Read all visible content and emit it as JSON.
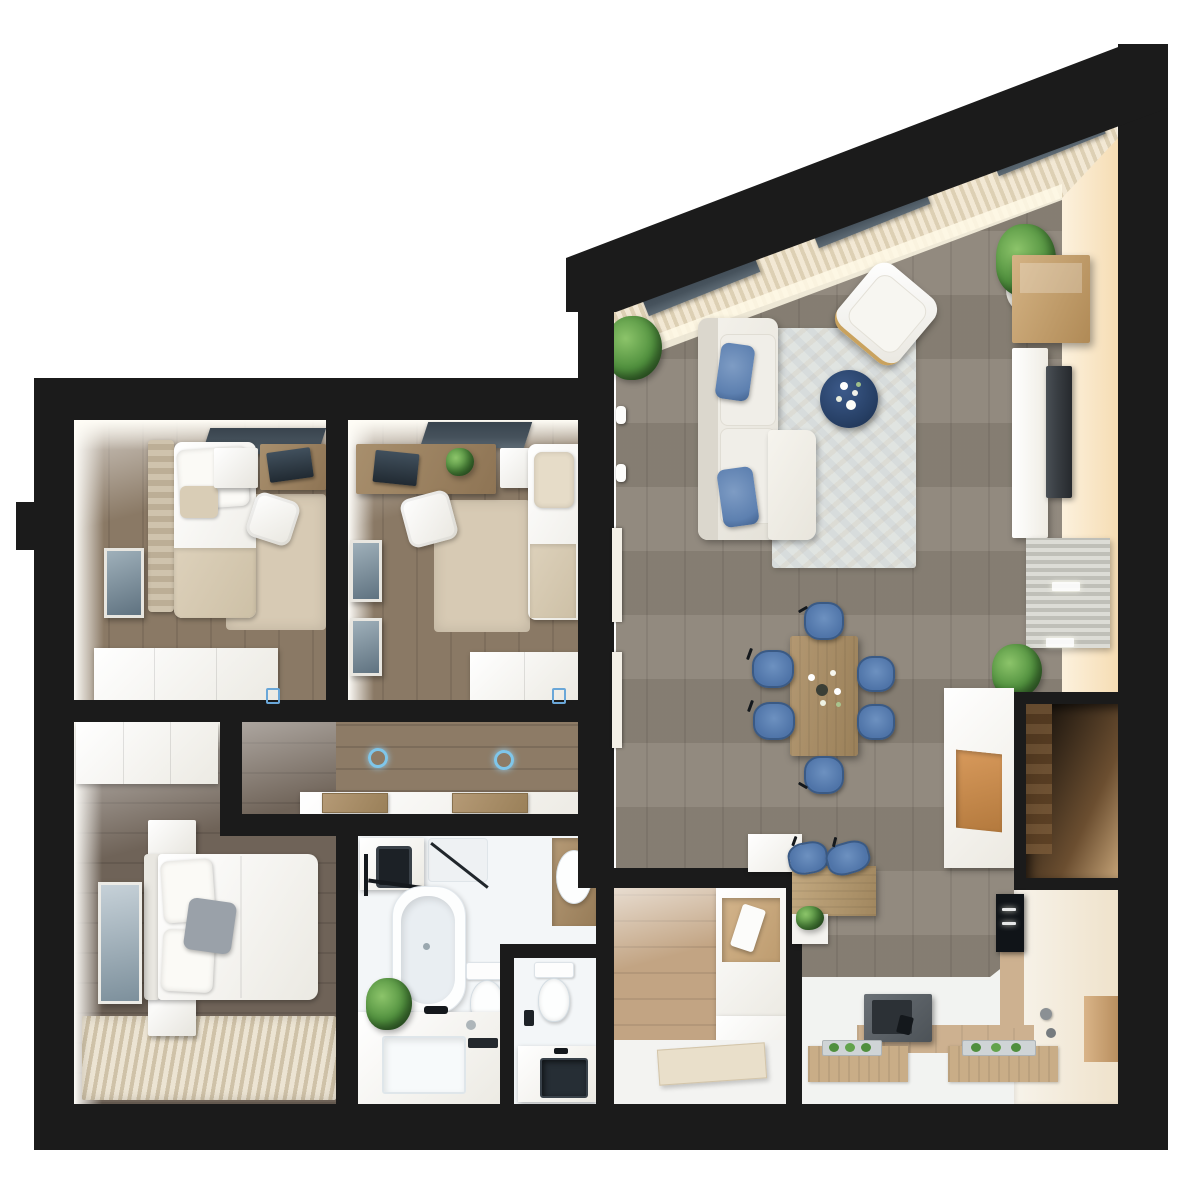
{
  "scene": {
    "kind": "3d-apartment-floor-plan-top-down-render",
    "background": "#ffffff",
    "wall_color": "#1b1b1b"
  },
  "palette": {
    "wall": "#1b1b1b",
    "living_floor": "#8c8478",
    "bedroom_floor": "#8a7965",
    "master_floor": "#6f6358",
    "hall_floor": "#8d7b66",
    "entry_floor": "#c2a483",
    "kitchen_wood": "#cdb190",
    "bath_floor": "#f3f6f8",
    "white_furniture": "#f5f4f0",
    "rug_beige": "#d7cab4",
    "rug_living": "#e0e4e1",
    "rug_stripe_a": "#ece4d3",
    "rug_stripe_b": "#cfc2a8",
    "pillow_blue": "#5d80b0",
    "chair_blue": "#4f74a8",
    "chair_blue_dark": "#3a5a85",
    "table_navy": "#274066",
    "wood": "#b29770",
    "desk_wood": "#9b8061",
    "curtain_a": "#f2e8d4",
    "curtain_b": "#ddd0b4",
    "valance": "#46525c",
    "cream_wall_a": "#f6ddb4",
    "cream_wall_b": "#fcf1dd",
    "plant_dark": "#2f5f26",
    "plant_mid": "#4f8f3d",
    "plant_light": "#8cc46a",
    "tv_screen": "#3a3f44",
    "steel": "#5a6066",
    "downlight_blue": "#7fc6ea",
    "mat_wood": "#c9ad87"
  },
  "rooms": [
    {
      "id": "living-dining",
      "furniture": [
        "l-shaped-white-sofa",
        "two-blue-throw-pillows",
        "light-patterned-area-rug",
        "round-navy-coffee-table-with-flowers",
        "white-accent-armchair-gold-frame",
        "slanted-window-wall-with-cream-curtains",
        "three-dark-window-valances",
        "potted-plant-north",
        "potted-plant-east",
        "wall-wood-shelf",
        "tv-sideboard",
        "wall-tv",
        "slatted-bench-with-two-lights",
        "potted-plant-south",
        "wood-dining-table-with-flower-centerpiece",
        "six-blue-dining-chairs",
        "open-wardrobe-niche",
        "white-cabinet-with-wood-front"
      ]
    },
    {
      "id": "kitchen",
      "furniture": [
        "breakfast-bar",
        "two-blue-bar-stools",
        "bar-planter",
        "dark-cooktop-unit",
        "built-in-oven-column",
        "white-counters",
        "two-wood-mats-with-herb-trays",
        "tall-white-cabinets"
      ]
    },
    {
      "id": "bedroom-1",
      "furniture": [
        "single-bed-striped-headboard",
        "beige-throw",
        "white-nightstand",
        "wood-desk-with-laptop",
        "white-desk-chair",
        "window-valance",
        "wall-picture",
        "beige-rug",
        "white-wardrobe"
      ]
    },
    {
      "id": "bedroom-2",
      "furniture": [
        "wood-desk-with-laptop-and-plant",
        "white-nightstand",
        "white-desk-chair",
        "single-bed",
        "window-valance",
        "two-wall-pictures",
        "beige-rug",
        "white-wardrobe"
      ]
    },
    {
      "id": "corridor",
      "furniture": [
        "low-white-sideboard",
        "two-wood-trays",
        "two-glowing-ceiling-downlights"
      ]
    },
    {
      "id": "master-bedroom",
      "furniture": [
        "white-wardrobe",
        "double-bed-with-gray-accent-pillow",
        "two-white-nightstands",
        "wall-picture",
        "striped-area-rug"
      ]
    },
    {
      "id": "bathroom",
      "furniture": [
        "washing-machine",
        "black-towel-rack",
        "shower-corner-with-glass",
        "bathtub",
        "toilet",
        "vanity-with-sink-and-black-faucet",
        "potted-plant",
        "corner-basin-with-wood-cabinet"
      ]
    },
    {
      "id": "wc",
      "furniture": [
        "toilet",
        "counter-with-dark-basin"
      ]
    },
    {
      "id": "entry-hall",
      "furniture": [
        "open-wardrobe-with-niche",
        "entrance-door",
        "white-landing"
      ]
    }
  ]
}
